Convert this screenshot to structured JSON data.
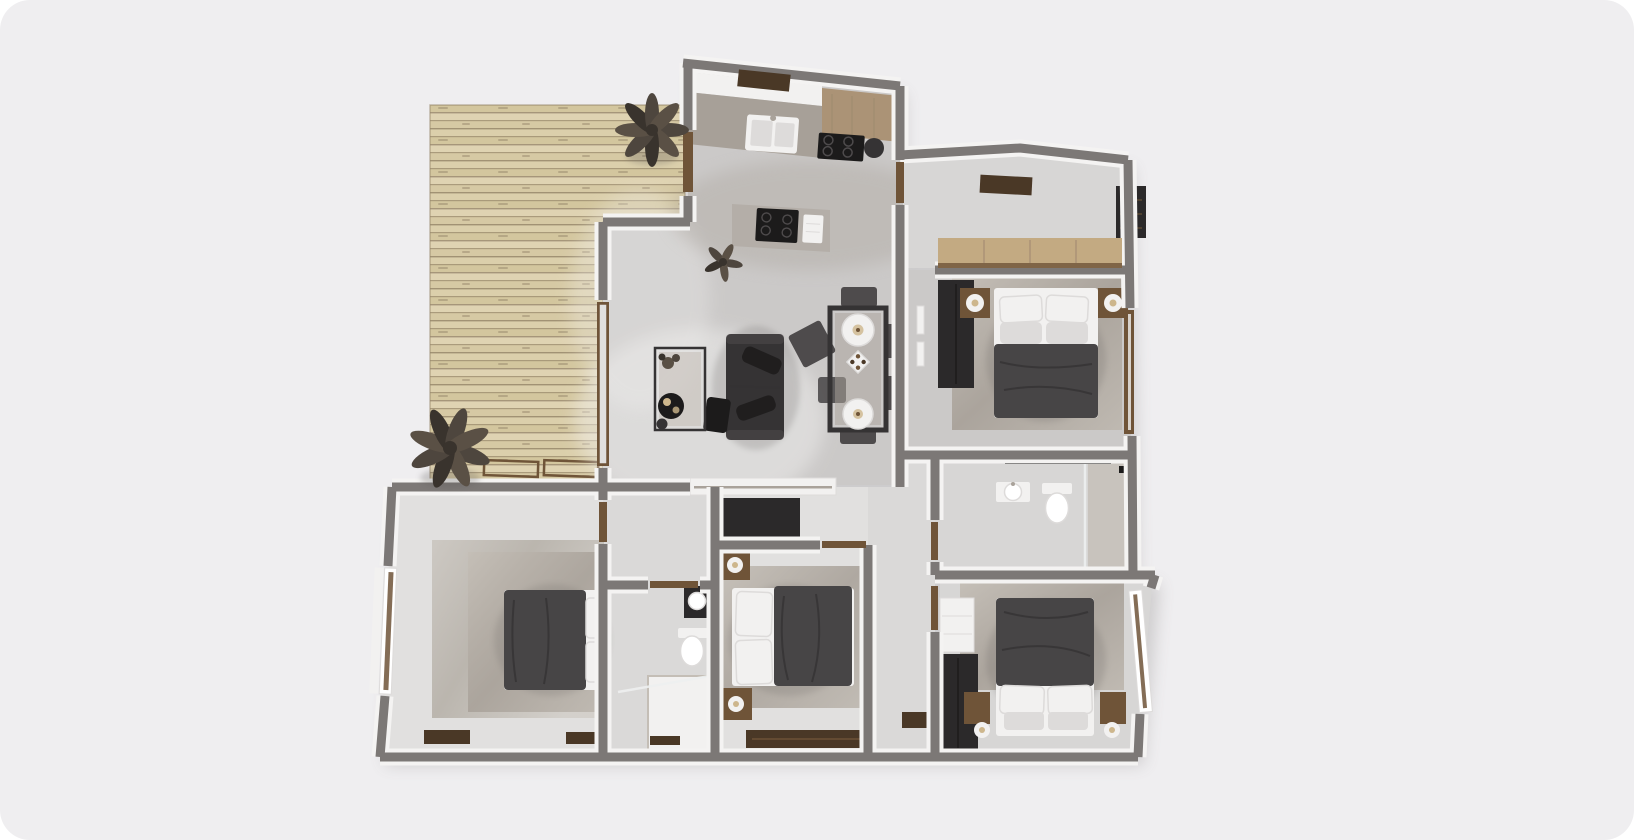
{
  "scene": {
    "label": "3d-apartment-floor-plan-top-view",
    "rooms": [
      {
        "name": "deck-terrace",
        "items": [
          "wood-planks",
          "potted-plant-top",
          "potted-plant-bottom",
          "lounger-frames"
        ]
      },
      {
        "name": "kitchen",
        "items": [
          "wall-counter",
          "double-sink",
          "gas-range",
          "wood-worktop",
          "island-cooktop",
          "towel",
          "floor-plant",
          "doormat"
        ]
      },
      {
        "name": "living-room",
        "items": [
          "sofa",
          "chaise",
          "coffee-table",
          "serving-tray",
          "sliding-door",
          "glazed-deck-door"
        ]
      },
      {
        "name": "dining-area",
        "items": [
          "glass-table",
          "pendant-lamp",
          "pendant-lamp",
          "centerpiece",
          "chairs-x6"
        ]
      },
      {
        "name": "master-suite-hall",
        "items": [
          "wardrobe-band-wood",
          "dark-shelf",
          "doormat"
        ]
      },
      {
        "name": "master-bedroom",
        "items": [
          "double-bed",
          "pillows",
          "nightstand-left",
          "nightstand-right",
          "wardrobe",
          "rug",
          "wall-frames",
          "side-door"
        ]
      },
      {
        "name": "main-bathroom",
        "items": [
          "toilet",
          "wall-sink",
          "walk-in-shower",
          "glass-screen",
          "towel-bar"
        ]
      },
      {
        "name": "hallway",
        "items": [
          "doormat"
        ]
      },
      {
        "name": "bedroom-bottom-left",
        "items": [
          "double-bed",
          "pillows",
          "rug",
          "angled-window",
          "doormats"
        ]
      },
      {
        "name": "small-bathroom",
        "items": [
          "vanity-sink",
          "toilet",
          "shower-tray",
          "glass-screen",
          "drain-mat"
        ]
      },
      {
        "name": "bedroom-bottom-center",
        "items": [
          "double-bed",
          "pillows",
          "wardrobe",
          "nightstands",
          "lamps",
          "rug",
          "low-dresser"
        ]
      },
      {
        "name": "bedroom-bottom-right",
        "items": [
          "double-bed",
          "pillows",
          "wardrobe",
          "white-shelf",
          "nightstands",
          "lamps",
          "rug",
          "window"
        ]
      }
    ]
  },
  "colors": {
    "bg": "#efeef0",
    "wall": "#7c7876",
    "wall-inner": "#f4f3f2",
    "floor-main": "#cbc9c8",
    "floor-soft": "#d7d6d5",
    "floor-light": "#e1e0df",
    "floor-hall": "#dad9d8",
    "deck-a": "#dbcfab",
    "deck-b": "#d3c69e",
    "deck-c": "#dfd3b2",
    "deck-d": "#d6c9a4",
    "deck-line": "#97876b",
    "rug-a": "#c4beb6",
    "rug-b": "#a9a29a",
    "rug-c": "#beb8b0",
    "conc-a": "#c8c3bc",
    "conc-b": "#b1aba2",
    "conc-c": "#d0ccc6",
    "furn-dark": "#353334",
    "chair": "#4e4b4c",
    "duvet": "#474546",
    "duvet-line": "#343233",
    "wardrobe": "#2b292a",
    "wood-dark": "#4a3826",
    "wood-mid": "#6f5438",
    "wood-light": "#c3aa82",
    "wood-counter": "#ab9376",
    "counter-gray": "#a7a098",
    "island-gray": "#b4aea8",
    "white-soft": "#f2f1f0",
    "pillow-shade": "#dddbda",
    "glass": "#eef0f0",
    "black": "#1c1b1b",
    "lamp-center": "#cdb68c",
    "leaf-a": "#4e463e",
    "leaf-b": "#5a5045",
    "leaf-c": "#39332d",
    "shadow": "#5a5654"
  }
}
